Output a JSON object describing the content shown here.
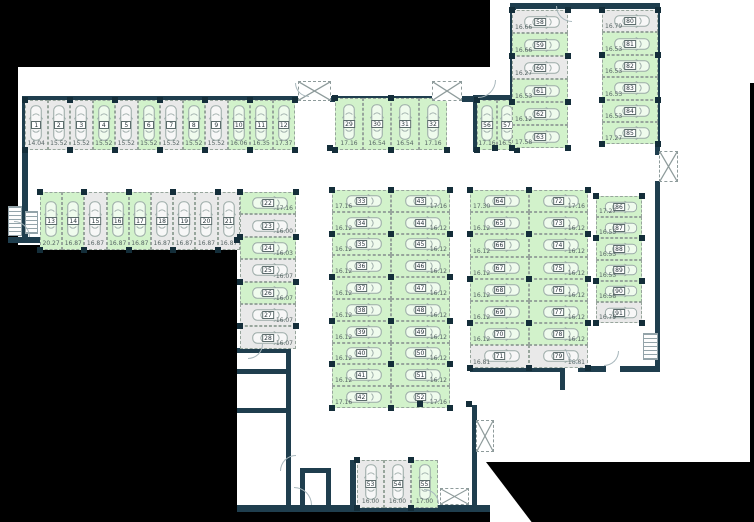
{
  "plan_type": "parking-garage-floor-plan",
  "colors": {
    "available": "#d2f2cb",
    "occupied": "#e9e9e9",
    "wall": "#1f3e4e",
    "outside": "#000000"
  },
  "sections": [
    {
      "id": "row-1-12",
      "stalls": [
        {
          "n": 1,
          "area": "14.04",
          "free": false
        },
        {
          "n": 2,
          "area": "15.52",
          "free": false
        },
        {
          "n": 3,
          "area": "15.52",
          "free": false
        },
        {
          "n": 4,
          "area": "15.52",
          "free": true
        },
        {
          "n": 5,
          "area": "15.52",
          "free": false
        },
        {
          "n": 6,
          "area": "15.52",
          "free": true
        },
        {
          "n": 7,
          "area": "15.52",
          "free": false
        },
        {
          "n": 8,
          "area": "15.52",
          "free": true
        },
        {
          "n": 9,
          "area": "15.52",
          "free": false
        },
        {
          "n": 10,
          "area": "16.06",
          "free": true
        },
        {
          "n": 11,
          "area": "16.35",
          "free": true
        },
        {
          "n": 12,
          "area": "17.37",
          "free": true
        }
      ]
    },
    {
      "id": "row-13-21",
      "stalls": [
        {
          "n": 13,
          "area": "20.27",
          "free": true
        },
        {
          "n": 14,
          "area": "16.87",
          "free": true
        },
        {
          "n": 15,
          "area": "16.87",
          "free": false
        },
        {
          "n": 16,
          "area": "16.87",
          "free": true
        },
        {
          "n": 17,
          "area": "16.87",
          "free": true
        },
        {
          "n": 18,
          "area": "16.87",
          "free": false
        },
        {
          "n": 19,
          "area": "16.87",
          "free": false
        },
        {
          "n": 20,
          "area": "16.87",
          "free": false
        },
        {
          "n": 21,
          "area": "16.87",
          "free": false
        }
      ]
    },
    {
      "id": "col-22-28",
      "stalls": [
        {
          "n": 22,
          "area": "17.16",
          "free": true
        },
        {
          "n": 23,
          "area": "16.00",
          "free": false
        },
        {
          "n": 24,
          "area": "16.03",
          "free": true
        },
        {
          "n": 25,
          "area": "16.07",
          "free": false
        },
        {
          "n": 26,
          "area": "16.07",
          "free": true
        },
        {
          "n": 27,
          "area": "16.07",
          "free": false
        },
        {
          "n": 28,
          "area": "16.07",
          "free": false
        }
      ]
    },
    {
      "id": "row-29-32",
      "stalls": [
        {
          "n": 29,
          "area": "17.16",
          "free": true
        },
        {
          "n": 30,
          "area": "16.54",
          "free": true
        },
        {
          "n": 31,
          "area": "16.54",
          "free": true
        },
        {
          "n": 32,
          "area": "17.16",
          "free": true
        }
      ]
    },
    {
      "id": "col-33-42",
      "stalls": [
        {
          "n": 33,
          "area": "17.16",
          "free": true
        },
        {
          "n": 34,
          "area": "16.12",
          "free": true
        },
        {
          "n": 35,
          "area": "16.12",
          "free": true
        },
        {
          "n": 36,
          "area": "16.12",
          "free": true
        },
        {
          "n": 37,
          "area": "16.12",
          "free": true
        },
        {
          "n": 38,
          "area": "16.12",
          "free": true
        },
        {
          "n": 39,
          "area": "16.12",
          "free": true
        },
        {
          "n": 40,
          "area": "16.12",
          "free": true
        },
        {
          "n": 41,
          "area": "16.12",
          "free": true
        },
        {
          "n": 42,
          "area": "17.16",
          "free": true
        }
      ]
    },
    {
      "id": "col-43-52",
      "stalls": [
        {
          "n": 43,
          "area": "17.16",
          "free": true
        },
        {
          "n": 44,
          "area": "16.12",
          "free": true
        },
        {
          "n": 45,
          "area": "16.12",
          "free": true
        },
        {
          "n": 46,
          "area": "16.12",
          "free": true
        },
        {
          "n": 47,
          "area": "16.12",
          "free": true
        },
        {
          "n": 48,
          "area": "16.12",
          "free": true
        },
        {
          "n": 49,
          "area": "16.12",
          "free": true
        },
        {
          "n": 50,
          "area": "16.12",
          "free": true
        },
        {
          "n": 51,
          "area": "16.12",
          "free": true
        },
        {
          "n": 52,
          "area": "17.16",
          "free": true
        }
      ]
    },
    {
      "id": "row-53-55",
      "stalls": [
        {
          "n": 53,
          "area": "16.00",
          "free": false
        },
        {
          "n": 54,
          "area": "16.00",
          "free": false
        },
        {
          "n": 55,
          "area": "17.00",
          "free": true
        }
      ]
    },
    {
      "id": "row-56-57",
      "stalls": [
        {
          "n": 56,
          "area": "17.16",
          "free": true
        },
        {
          "n": 57,
          "area": "16.54",
          "free": true
        }
      ]
    },
    {
      "id": "col-58-63",
      "stalls": [
        {
          "n": 58,
          "area": "16.66",
          "free": false
        },
        {
          "n": 59,
          "area": "16.66",
          "free": true
        },
        {
          "n": 60,
          "area": "16.27",
          "free": false
        },
        {
          "n": 61,
          "area": "16.53",
          "free": true
        },
        {
          "n": 62,
          "area": "16.12",
          "free": true
        },
        {
          "n": 63,
          "area": "17.58",
          "free": true
        }
      ]
    },
    {
      "id": "col-64-71",
      "stalls": [
        {
          "n": 64,
          "area": "17.30",
          "free": true
        },
        {
          "n": 65,
          "area": "16.12",
          "free": true
        },
        {
          "n": 66,
          "area": "16.12",
          "free": true
        },
        {
          "n": 67,
          "area": "16.12",
          "free": true
        },
        {
          "n": 68,
          "area": "16.12",
          "free": true
        },
        {
          "n": 69,
          "area": "16.12",
          "free": true
        },
        {
          "n": 70,
          "area": "16.12",
          "free": true
        },
        {
          "n": 71,
          "area": "16.81",
          "free": false
        }
      ]
    },
    {
      "id": "col-72-79",
      "stalls": [
        {
          "n": 72,
          "area": "17.16",
          "free": true
        },
        {
          "n": 73,
          "area": "16.12",
          "free": true
        },
        {
          "n": 74,
          "area": "16.12",
          "free": true
        },
        {
          "n": 75,
          "area": "16.12",
          "free": true
        },
        {
          "n": 76,
          "area": "16.12",
          "free": true
        },
        {
          "n": 77,
          "area": "16.12",
          "free": true
        },
        {
          "n": 78,
          "area": "16.12",
          "free": true
        },
        {
          "n": 79,
          "area": "16.81",
          "free": false
        }
      ]
    },
    {
      "id": "col-80-85",
      "stalls": [
        {
          "n": 80,
          "area": "16.79",
          "free": false
        },
        {
          "n": 81,
          "area": "16.53",
          "free": true
        },
        {
          "n": 82,
          "area": "16.53",
          "free": true
        },
        {
          "n": 83,
          "area": "16.53",
          "free": true
        },
        {
          "n": 84,
          "area": "16.53",
          "free": true
        },
        {
          "n": 85,
          "area": "17.27",
          "free": true
        }
      ]
    },
    {
      "id": "col-86-91",
      "stalls": [
        {
          "n": 86,
          "area": "17.27",
          "free": true
        },
        {
          "n": 87,
          "area": "16.53",
          "free": true
        },
        {
          "n": 88,
          "area": "16.53",
          "free": true
        },
        {
          "n": 89,
          "area": "16.53",
          "free": true
        },
        {
          "n": 90,
          "area": "16.58",
          "free": true
        },
        {
          "n": 91,
          "area": "16.79",
          "free": false
        }
      ]
    }
  ]
}
